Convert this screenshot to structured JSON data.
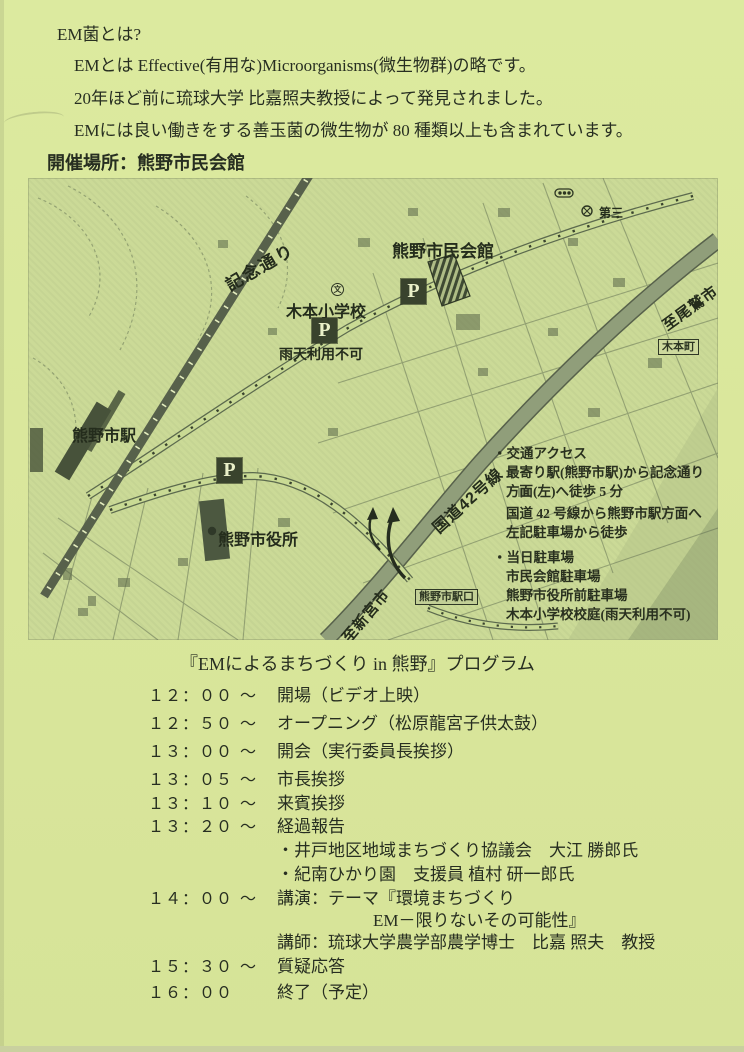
{
  "colors": {
    "page_bg": "#dbe89e",
    "map_bg": "#cbda97",
    "ink": "#2a3125",
    "parking_box_bg": "#39432d",
    "route42_band": "#909e7a"
  },
  "intro": {
    "heading": "EM菌とは?",
    "line1": "EMとは Effective(有用な)Microorganisms(微生物群)の略です。",
    "line2": "20年ほど前に琉球大学 比嘉照夫教授によって発見されました。",
    "line3": "EMには良い働きをする善玉菌の微生物が 80 種類以上も含まれています。",
    "venue": "開催場所：熊野市民会館"
  },
  "map": {
    "kinendori": "記念通り",
    "kimoto_elementary": "木本小学校",
    "rain_note": "雨天利用不可",
    "civic_hall": "熊野市民会館",
    "daisan": "第三",
    "to_owase": "至尾鷲市",
    "kimoto_cho": "木本町",
    "kumano_station": "熊野市駅",
    "city_hall": "熊野市役所",
    "route42": "国道42号線",
    "to_shingu": "至新宮市",
    "station_entrance": "熊野市駅口",
    "parking_label": "P",
    "school_symbol": "文",
    "access": {
      "lines": [
        "・交通アクセス",
        "最寄り駅(熊野市駅)から記念通り",
        "方面(左)へ徒歩 5 分",
        "国道 42 号線から熊野市駅方面へ",
        "左記駐車場から徒歩",
        "・当日駐車場",
        "市民会館駐車場",
        "熊野市役所前駐車場",
        "木本小学校校庭(雨天利用不可)"
      ]
    }
  },
  "program": {
    "title": "『EMによるまちづくり in 熊野』プログラム",
    "rows": [
      {
        "time": "１２：００",
        "tilde": "～",
        "text": "開場（ビデオ上映）"
      },
      {
        "time": "１２：５０",
        "tilde": "～",
        "text": "オープニング（松原龍宮子供太鼓）"
      },
      {
        "time": "１３：００",
        "tilde": "～",
        "text": "開会（実行委員長挨拶）"
      },
      {
        "time": "１３：０５",
        "tilde": "～",
        "text": "市長挨拶"
      },
      {
        "time": "１３：１０",
        "tilde": "～",
        "text": "来賓挨拶"
      },
      {
        "time": "１３：２０",
        "tilde": "～",
        "text": "経過報告"
      },
      {
        "time": "",
        "tilde": "",
        "text": "・井戸地区地域まちづくり協議会　大江 勝郎氏"
      },
      {
        "time": "",
        "tilde": "",
        "text": "・紀南ひかり園　支援員 植村 研一郎氏"
      },
      {
        "time": "１４：００",
        "tilde": "～",
        "text": "講演：テーマ『環境まちづくり"
      },
      {
        "time": "",
        "tilde": "",
        "text": "EM－限りないその可能性』"
      },
      {
        "time": "",
        "tilde": "",
        "text": "講師：琉球大学農学部農学博士　比嘉 照夫　教授"
      },
      {
        "time": "１５：３０",
        "tilde": "～",
        "text": "質疑応答"
      },
      {
        "time": "１６：００",
        "tilde": "",
        "text": "終了（予定）"
      }
    ]
  }
}
